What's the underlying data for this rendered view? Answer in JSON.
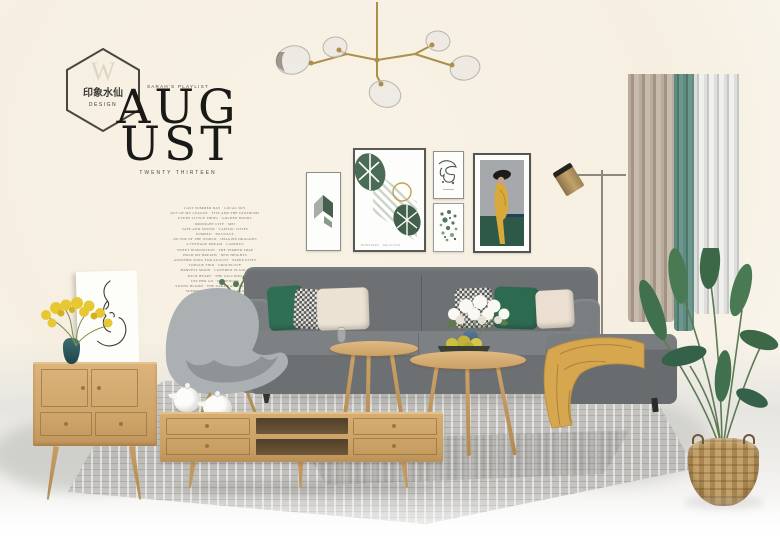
{
  "logo": {
    "monogram": "W",
    "brand": "印象水仙",
    "sub": "DESIGN"
  },
  "masthead": {
    "eyebrow": "SARAH'S PLAYLIST",
    "title_line1": "AUG",
    "title_line2": "UST",
    "subtitle": "TWENTY THIRTEEN"
  },
  "playlist": {
    "lines": [
      "LAST SUMMER DAY · LOCAL SKY",
      "OUT OF MY LEAGUE · FITZ AND THE TANTRUMS",
      "EVERY LITTLE THING · GOLDEN HOURS",
      "MIDNIGHT CITY · M83",
      "SAFE AND SOUND · CAPITAL CITIES",
      "POMPEII · BASTILLE",
      "ON TOP OF THE WORLD · IMAGINE DRAGONS",
      "A TEENAGE DREAM · CANDLES",
      "SWEET DISPOSITION · THE TEMPER TRAP",
      "HOLD MY BREATH · NEW HEIGHTS",
      "ANOTHER SONG FOR AUGUST · PAPER KITES",
      "TONGUE TIED · GROUPLOVE",
      "HARVEST MOON · COVERED IN GOLD",
      "WILD HEART · THE VACCINES",
      "LET HER GO · PASSENGER",
      "YOUNG BLOOD · THE NAKED AND FAMOUS",
      "SUMMERTIME SADNESS · LANA",
      "THE WIRE · HAIM",
      "WE CAME TO DANCE · GOSPEL",
      "BY THE SEA · MORNING AIR",
      "SHUT UP AND DANCE · SEPTEMBER",
      "FOLLOW THE SUN · XAVIER RUDD",
      "RIPTIDE · VANCE JOY",
      "BUDAPEST · GEORGE EZRA",
      "THE BELL TOLL · EVENING GLOW",
      "LOVE NATURAL · THE CROOKES",
      "GOODNIGHT · AUGUST ENDS",
      "SEE YOU IN SEPTEMBER · THE CLOSERS"
    ]
  },
  "frames": {
    "monstera_caption": "MONSTERA · DELICIOSA"
  },
  "palette": {
    "wall_cream": "#f6efe1",
    "sofa_gray": "#6e7173",
    "pillow_green": "#2f7055",
    "pillow_cream": "#ece2d4",
    "oak_wood": "#cda368",
    "curtain_beige": "#b0a294",
    "curtain_teal": "#5f8b80",
    "throw_mustard": "#d7a74f",
    "plant_green": "#41704e",
    "brass_gold": "#b0924e",
    "vase_teal": "#2d5a60",
    "vase_blue": "#3c587e",
    "rug_gray": "#c4c3bf"
  }
}
